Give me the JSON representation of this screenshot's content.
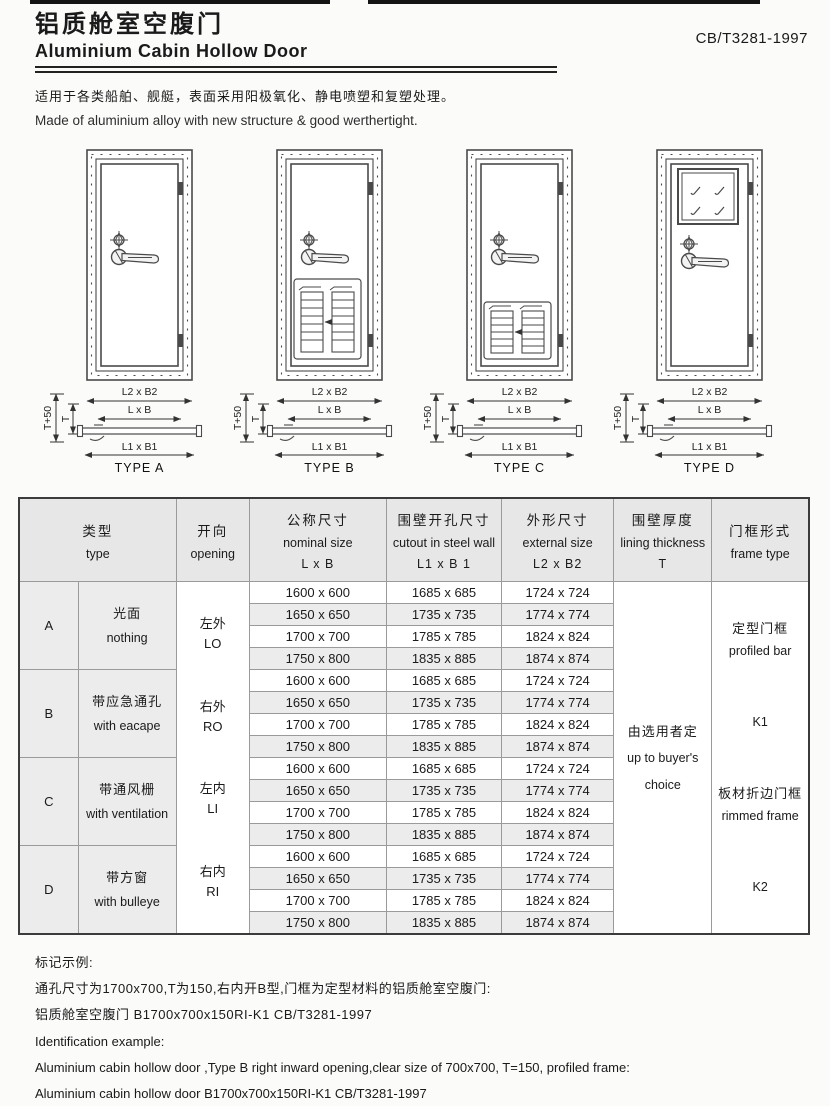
{
  "page": {
    "title_zh": "铝质舱室空腹门",
    "title_en": "Aluminium Cabin Hollow Door",
    "standard": "CB/T3281-1997",
    "desc_zh": "适用于各类船舶、舰艇，表面采用阳极氧化、静电喷塑和复塑处理。",
    "desc_en": "Made of aluminium alloy with new structure & good werthertight."
  },
  "figures": {
    "dims": {
      "l2b2": "L2 x B2",
      "lxb": "L x B",
      "l1b1": "L1 x B1",
      "t50": "T+50",
      "t": "T"
    },
    "items": [
      {
        "label": "TYPE A",
        "variant": "plain-door"
      },
      {
        "label": "TYPE B",
        "variant": "door-with-escape-louver-panel"
      },
      {
        "label": "TYPE C",
        "variant": "door-with-ventilation-louver-panel"
      },
      {
        "label": "TYPE D",
        "variant": "door-with-square-window"
      }
    ]
  },
  "table": {
    "headers": {
      "type": {
        "zh": "类型",
        "en": "type"
      },
      "opening": {
        "zh": "开向",
        "en": "opening"
      },
      "nominal": {
        "zh": "公称尺寸",
        "en": "nominal size",
        "sub": "L x B"
      },
      "cutout": {
        "zh": "围壁开孔尺寸",
        "en": "cutout in steel wall",
        "sub": "L1 x B 1"
      },
      "external": {
        "zh": "外形尺寸",
        "en": "external  size",
        "sub": "L2 x B2"
      },
      "lining": {
        "zh": "围壁厚度",
        "en": "lining thickness",
        "sub": "T"
      },
      "frame": {
        "zh": "门框形式",
        "en": "frame type"
      }
    },
    "groups": [
      {
        "letter": "A",
        "desc_zh": "光面",
        "desc_en": "nothing"
      },
      {
        "letter": "B",
        "desc_zh": "带应急通孔",
        "desc_en": "with eacape"
      },
      {
        "letter": "C",
        "desc_zh": "带通风栅",
        "desc_en": "with ventilation"
      },
      {
        "letter": "D",
        "desc_zh": "带方窗",
        "desc_en": "with bulleye"
      }
    ],
    "openings": [
      {
        "zh": "左外",
        "en": "LO"
      },
      {
        "zh": "右外",
        "en": "RO"
      },
      {
        "zh": "左内",
        "en": "LI"
      },
      {
        "zh": "右内",
        "en": "RI"
      }
    ],
    "rows": [
      {
        "nominal": "1600 x 600",
        "cutout": "1685 x 685",
        "external": "1724 x 724"
      },
      {
        "nominal": "1650 x 650",
        "cutout": "1735 x 735",
        "external": "1774 x 774"
      },
      {
        "nominal": "1700 x 700",
        "cutout": "1785 x 785",
        "external": "1824 x 824"
      },
      {
        "nominal": "1750 x 800",
        "cutout": "1835 x 885",
        "external": "1874 x 874"
      },
      {
        "nominal": "1600 x 600",
        "cutout": "1685 x 685",
        "external": "1724 x 724"
      },
      {
        "nominal": "1650 x 650",
        "cutout": "1735 x 735",
        "external": "1774 x 774"
      },
      {
        "nominal": "1700 x 700",
        "cutout": "1785 x 785",
        "external": "1824 x 824"
      },
      {
        "nominal": "1750 x 800",
        "cutout": "1835 x 885",
        "external": "1874 x 874"
      },
      {
        "nominal": "1600 x 600",
        "cutout": "1685 x 685",
        "external": "1724 x 724"
      },
      {
        "nominal": "1650 x 650",
        "cutout": "1735 x 735",
        "external": "1774 x 774"
      },
      {
        "nominal": "1700 x 700",
        "cutout": "1785 x 785",
        "external": "1824 x 824"
      },
      {
        "nominal": "1750 x 800",
        "cutout": "1835 x 885",
        "external": "1874 x 874"
      },
      {
        "nominal": "1600 x 600",
        "cutout": "1685 x 685",
        "external": "1724 x 724"
      },
      {
        "nominal": "1650 x 650",
        "cutout": "1735 x 735",
        "external": "1774 x 774"
      },
      {
        "nominal": "1700 x 700",
        "cutout": "1785 x 785",
        "external": "1824 x 824"
      },
      {
        "nominal": "1750 x 800",
        "cutout": "1835 x 885",
        "external": "1874 x 874"
      }
    ],
    "lining_cell": {
      "zh": "由选用者定",
      "en1": "up to buyer's",
      "en2": "choice"
    },
    "frame_cell": {
      "k1_zh": "定型门框",
      "k1_en": "profiled bar",
      "k1": "K1",
      "k2_zh": "板材折边门框",
      "k2_en": "rimmed frame",
      "k2": "K2"
    }
  },
  "example": {
    "heading_zh": "标记示例:",
    "line1_zh": "通孔尺寸为1700x700,T为150,右内开B型,门框为定型材料的铝质舱室空腹门:",
    "line2_zh": "铝质舱室空腹门 B1700x700x150RI-K1 CB/T3281-1997",
    "heading_en": "Identification example:",
    "line1_en": "Aluminium cabin hollow door ,Type B right inward opening,clear size of 700x700, T=150, profiled frame:",
    "line2_en": "Aluminium cabin hollow door B1700x700x150RI-K1 CB/T3281-1997"
  },
  "colors": {
    "header_bg": "#e7e7e7",
    "alt_row_bg": "#ececec",
    "line": "#4a4a4a",
    "text": "#1a1a1a"
  }
}
